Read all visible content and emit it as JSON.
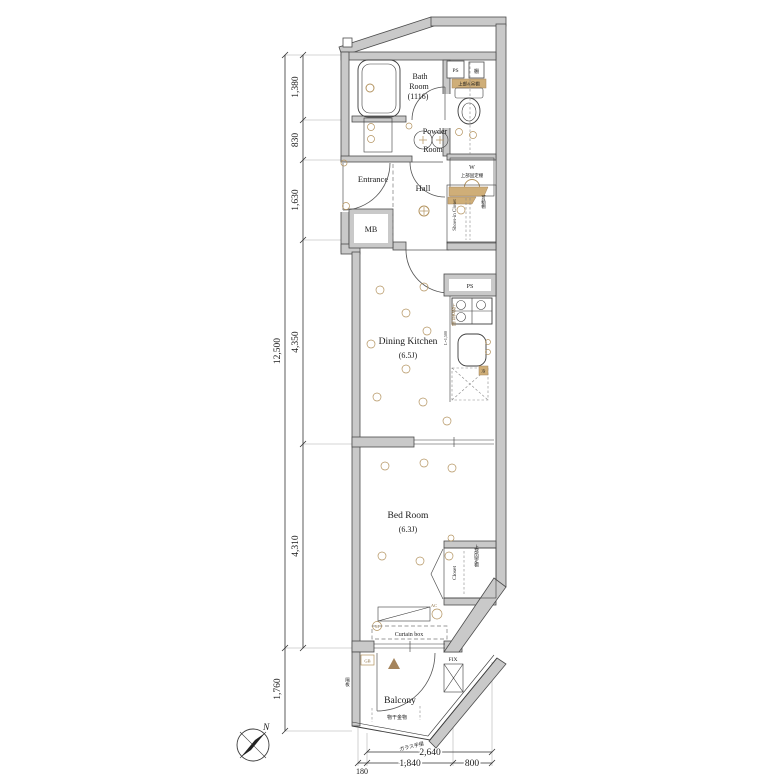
{
  "rooms": {
    "bath": {
      "l1": "Bath",
      "l2": "Room",
      "size": "(1116)"
    },
    "powder": {
      "l1": "Powder",
      "l2": "Room"
    },
    "entrance": "Entrance",
    "hall": "Hall",
    "mb": "MB",
    "dining_kitchen": {
      "l1": "Dining Kitchen",
      "size": "(6.5J)"
    },
    "bed_room": {
      "l1": "Bed Room",
      "size": "(6.3J)"
    },
    "balcony": "Balcony"
  },
  "storage": {
    "shoes_closet": "Shoes-in Closet",
    "shoes_shelf": "可動棚",
    "closet": "Closet",
    "closet_shelf": "上部固定棚",
    "toilet_shelf": "上部&吊棚",
    "washer": "W",
    "washer_shelf": "上部固定棚",
    "kitchen_shelf": "上部吊戸棚",
    "kitchen_shelf_len": "L=1,500"
  },
  "labels": {
    "ps_upper": "PS",
    "ps_kitchen": "PS",
    "tana": "棚",
    "fridge": "冷",
    "curtain_box": "Curtain box",
    "fix": "FIX",
    "gb": "GB",
    "ac": "AC",
    "m": "M",
    "monohoshi": "物干金物",
    "glass_rail": "ガラス手摺",
    "kakuita": "隔板",
    "north": "N"
  },
  "dimensions": {
    "vertical_total": "12,500",
    "vertical": [
      "1,380",
      "830",
      "1,630",
      "4,350",
      "4,310"
    ],
    "balcony_depth": "1,760",
    "horizontal_total": "2,640",
    "horizontal": [
      "180",
      "1,840",
      "800"
    ]
  },
  "colors": {
    "wall_fill": "#c9c9c9",
    "line": "#3c3c3c",
    "accent_tan": "#b3935f"
  }
}
